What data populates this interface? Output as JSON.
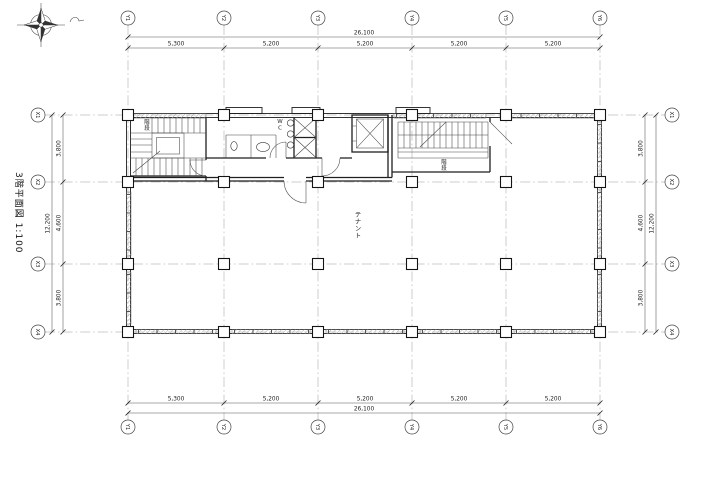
{
  "title": {
    "label": "3階平面図 1:100"
  },
  "drawing": {
    "grid": {
      "columns": {
        "labels": [
          "Y1",
          "Y2",
          "Y3",
          "Y4",
          "Y5",
          "Y6"
        ]
      },
      "rows": {
        "labels": [
          "X1",
          "X2",
          "X3",
          "X4"
        ]
      }
    },
    "dimensions": {
      "top": {
        "total": "26,100",
        "segments": [
          "5,300",
          "5,200",
          "5,200",
          "5,200",
          "5,200"
        ]
      },
      "bottom": {
        "total": "26,100",
        "segments": [
          "5,300",
          "5,200",
          "5,200",
          "5,200",
          "5,200"
        ]
      },
      "left": {
        "total": "12,200",
        "segments": [
          "3,800",
          "4,600",
          "3,800"
        ]
      },
      "right": {
        "total": "12,200",
        "segments": [
          "3,800",
          "4,600",
          "3,800"
        ]
      }
    },
    "labels": {
      "stair1": "階段",
      "wc": "WC",
      "stair2": "階段",
      "tenant": "テナント"
    }
  },
  "colors": {
    "line": "#1f1f1f",
    "dim": "#222222",
    "window_hatch": "#aaaaaa",
    "background": "#ffffff"
  }
}
